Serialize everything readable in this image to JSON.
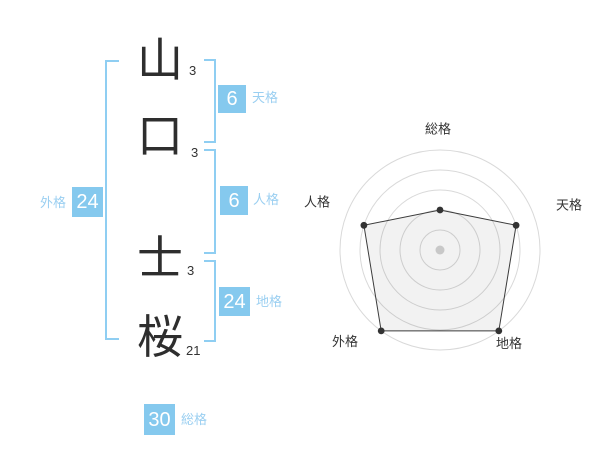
{
  "name": {
    "characters": [
      {
        "char": "山",
        "strokes": "3"
      },
      {
        "char": "口",
        "strokes": "3"
      },
      {
        "char": "士",
        "strokes": "3"
      },
      {
        "char": "桜",
        "strokes": "21"
      }
    ]
  },
  "scores": {
    "tenkaku": {
      "value": "6",
      "label": "天格"
    },
    "jinkaku": {
      "value": "6",
      "label": "人格"
    },
    "chikaku": {
      "value": "24",
      "label": "地格"
    },
    "gaikaku": {
      "value": "24",
      "label": "外格"
    },
    "soukaku": {
      "value": "30",
      "label": "総格"
    }
  },
  "chart_data": {
    "type": "radar",
    "axes": [
      "総格",
      "天格",
      "地格",
      "外格",
      "人格"
    ],
    "values": [
      40,
      80,
      100,
      100,
      80
    ],
    "max": 100,
    "rings": [
      20,
      40,
      60,
      80,
      100
    ],
    "grid": "circular",
    "legend": "none",
    "title": ""
  },
  "colors": {
    "accent_blue": "#85C9EE",
    "bracket_blue": "#8FCEF2",
    "label_blue": "#9ACFF1",
    "ink": "#333333",
    "ring_gray": "#D9D9D9",
    "fill_gray": "rgba(0,0,0,0.05)",
    "center_dot": "#C8C8C8"
  }
}
